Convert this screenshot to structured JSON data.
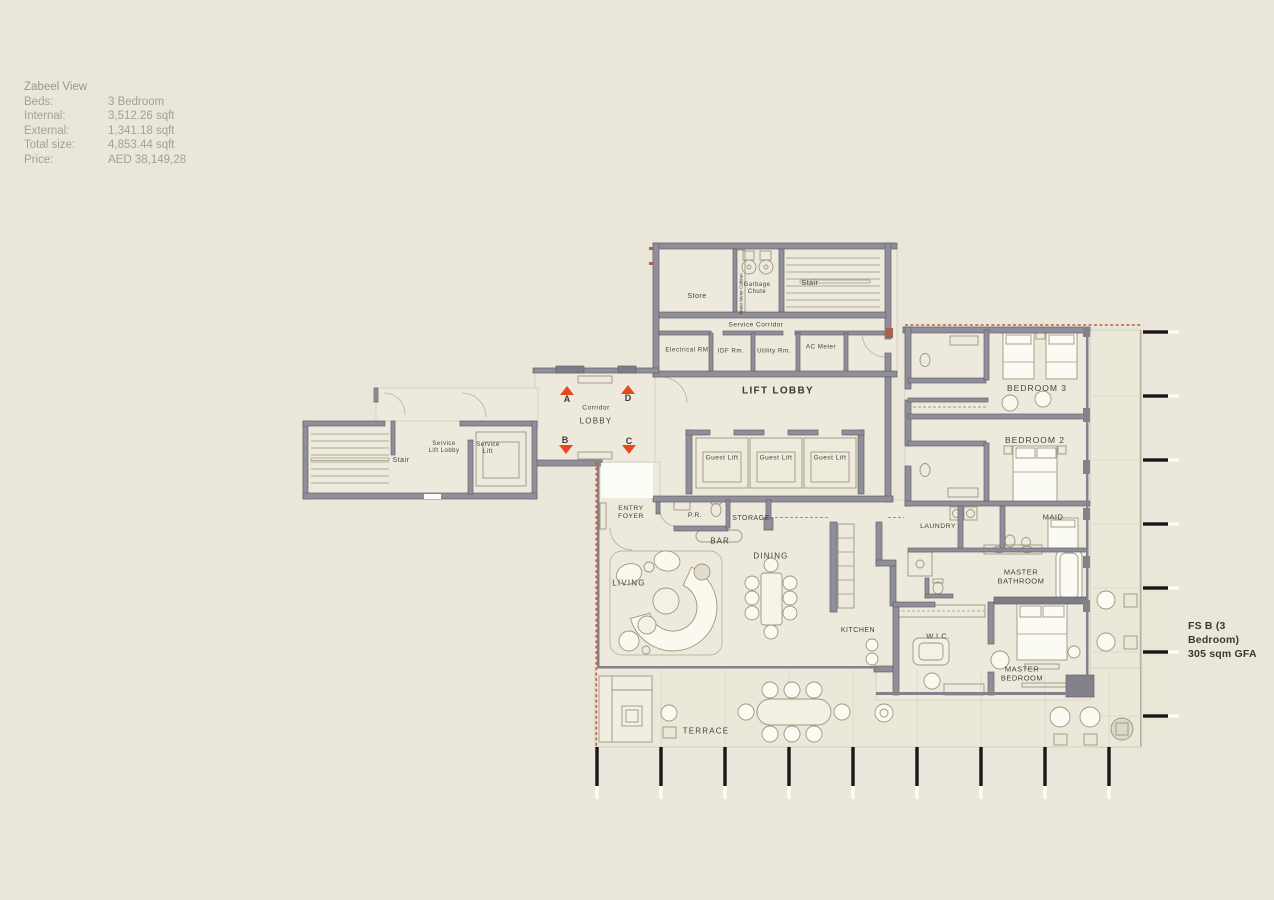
{
  "info_panel": {
    "title": "Zabeel View",
    "rows": [
      {
        "label": "Beds:",
        "value": "3 Bedroom"
      },
      {
        "label": "Internal:",
        "value": "3,512.26 sqft"
      },
      {
        "label": "External:",
        "value": "1,341.18  sqft"
      },
      {
        "label": "Total size:",
        "value": "4,853.44 sqft"
      },
      {
        "label": "Price:",
        "value": "AED  38,149,28"
      }
    ]
  },
  "plan": {
    "unit_label": {
      "line_1": "FS B (3 Bedroom)",
      "line_2": "305 sqm GFA"
    },
    "rooms": {
      "store": "Store",
      "garbage_chute": "Garbage\nChute",
      "stair_top": "Stair",
      "water_meter": "Water Meter Cabinet",
      "service_corridor": "Service Corridor",
      "electrical_rm": "Electrical RM.",
      "idf_rm": "IDF Rm.",
      "utility_rm": "Utility Rm.",
      "ac_meter": "AC Meter",
      "lift_lobby": "LIFT LOBBY",
      "corridor": "Corridor",
      "lobby": "LOBBY",
      "guest_lift": "Guest Lift",
      "stair_left": "Stair",
      "service_lift_lobby": "Service\nLift Lobby",
      "service_lift": "Service\nLift",
      "entry_foyer": "ENTRY\nFOYER",
      "powder_room": "P.R.",
      "storage": "STORAGE",
      "bar": "BAR",
      "dining": "DINING",
      "living": "LIVING",
      "kitchen": "KITCHEN",
      "wic": "W.I.C.",
      "master_bedroom": "MASTER\nBEDROOM",
      "master_bathroom": "MASTER\nBATHROOM",
      "laundry": "LAUNDRY",
      "maid": "MAID",
      "bedroom_3": "BEDROOM 3",
      "bedroom_2": "BEDROOM 2",
      "terrace": "TERRACE"
    },
    "markers": {
      "a": "A",
      "b": "B",
      "c": "C",
      "d": "D"
    }
  },
  "colors": {
    "background": "#eae7da",
    "wall": "#8f8e99",
    "marker_arrow": "#e8481f",
    "boundary_dash": "#bf5e3c",
    "grid_tick": "#17171a"
  }
}
